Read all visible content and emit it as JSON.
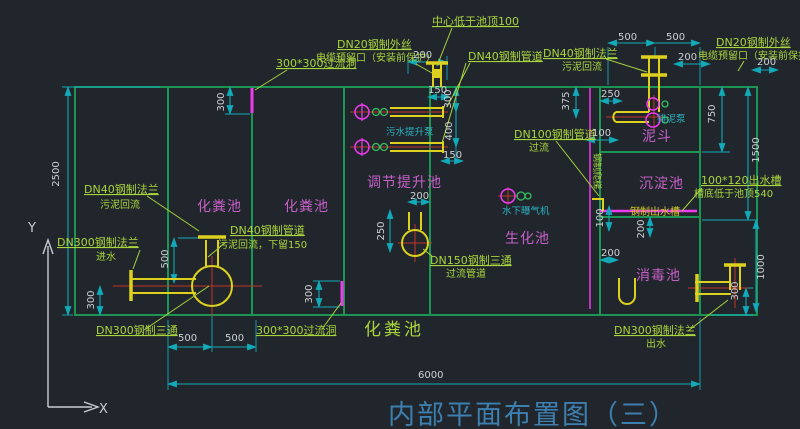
{
  "title": "内部平面布置图（三）",
  "axis": {
    "x": "X",
    "y": "Y"
  },
  "tanks": {
    "septic1": "化粪池",
    "septic2": "化粪池",
    "septic_bottom": "化粪池",
    "regulating": "调节提升池",
    "bio": "生化池",
    "sediment": "沉淀池",
    "hopper": "泥斗",
    "disinfect": "消毒池"
  },
  "equipment": {
    "sewage_pump": "污水提升泵",
    "aerator": "水下曝气机",
    "sludge_pump": "排泥泵",
    "ladder": "钢制爬梯",
    "outlet_trough": "钢制出水槽"
  },
  "callouts": {
    "center_top": "中心低于池顶100",
    "dn20_left_1": "DN20钢制外丝",
    "dn20_left_2": "电缆预留口（安装前保护）",
    "overflow_top": "300*300过流洞",
    "dn40_pipe": "DN40钢制管道",
    "dn40_flange_mid_1": "DN40钢制法兰",
    "dn40_flange_mid_2": "污泥回流",
    "dn20_right_1": "DN20钢制外丝",
    "dn20_right_2": "电缆预留口（安装前保护）",
    "dn40_flange_left_1": "DN40钢制法兰",
    "dn40_flange_left_2": "污泥回流",
    "dn300_inlet_1": "DN300钢制法兰",
    "dn300_inlet_2": "进水",
    "dn40_return_1": "DN40钢制管道",
    "dn40_return_2": "污泥回流，下留150",
    "dn150_tee_1": "DN150钢制三通",
    "dn150_tee_2": "过流管道",
    "dn100_1": "DN100钢制管道",
    "dn100_2": "过流",
    "trough_1": "100*120出水槽",
    "trough_2": "槽底低于池顶540",
    "dn300_outlet_1": "DN300钢制法兰",
    "dn300_outlet_2": "出水",
    "dn300_tee": "DN300钢制三通",
    "overflow_bottom": "300*300过流洞"
  },
  "dims": {
    "top_center_200": "200",
    "pump_150a": "150",
    "pump_300": "300",
    "pump_400": "400",
    "pump_150b": "150",
    "pump_200": "200",
    "tee_250": "250",
    "tr_500a": "500",
    "tr_500b": "500",
    "tr_200a": "200",
    "tr_200b": "200",
    "hop_375": "375",
    "hop_250": "250",
    "hop_100": "100",
    "right_750": "750",
    "right_1500": "1500",
    "weir_100": "100",
    "weir_200a": "200",
    "weir_200b": "200",
    "out_300": "300",
    "right_1000": "1000",
    "wall_300_top": "300",
    "wall_300_mid": "300",
    "inlet_300": "300",
    "inlet_500": "500",
    "total_2500": "2500",
    "bot_500a": "500",
    "bot_500b": "500",
    "total_6000": "6000"
  },
  "colors": {
    "background": "#20262c",
    "wall_green": "#1c9552",
    "dim_cyan": "#12aab8",
    "callout_green": "#aad43c",
    "label_magenta": "#c85fc8",
    "opening_magenta": "#ee3bee",
    "pipe_yellow": "#ddd01e",
    "centerline_red": "#c33327",
    "equip_cyan": "#2cb3c3",
    "title_blue": "#3d7fae",
    "dim_text": "#ccd1d4"
  }
}
